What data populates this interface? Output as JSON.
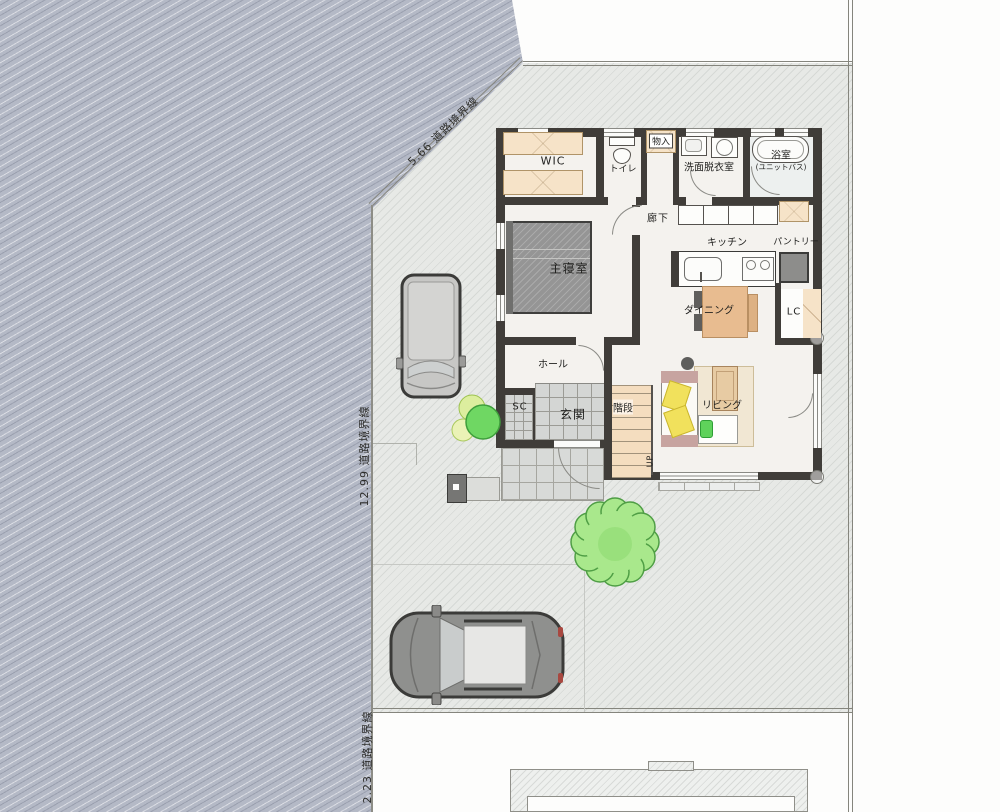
{
  "boundary_labels": {
    "north_diagonal": "5.66 道路境界線",
    "west": "12.99 道路境界線",
    "south": "2.23 道路境界線"
  },
  "rooms": {
    "wic": "WIC",
    "toilet": "トイレ",
    "storage": "物入",
    "washroom": "洗面脱衣室",
    "bathroom_line1": "浴室",
    "bathroom_line2": "(ユニットバス)",
    "corridor": "廊下",
    "master_bedroom": "主寝室",
    "kitchen": "キッチン",
    "pantry": "パントリー",
    "dining": "ダイニング",
    "living_closet": "LC",
    "living": "リビング",
    "hall": "ホール",
    "shoe_closet": "SC",
    "entrance": "玄関",
    "stairs": "階段",
    "stairs_up": "UP"
  },
  "colors": {
    "road": "#b4b9c6",
    "lot": "#e7e9e6",
    "wall": "#403d39",
    "floor": "#f4f2ee",
    "stairs": "#f4ddbf",
    "genkan_tile": "#d4d6d4",
    "dining_table": "#e8bc90",
    "rug": "#f1e7d3",
    "sofa_accent": "#c7a4a0",
    "cushion_yellow": "#f1e15c",
    "cushion_green": "#5fd25b",
    "bed": "#959595",
    "closet_shelf": "#f6e3c8",
    "tree": "#8ede77",
    "car_gray": "#9a9a98"
  }
}
